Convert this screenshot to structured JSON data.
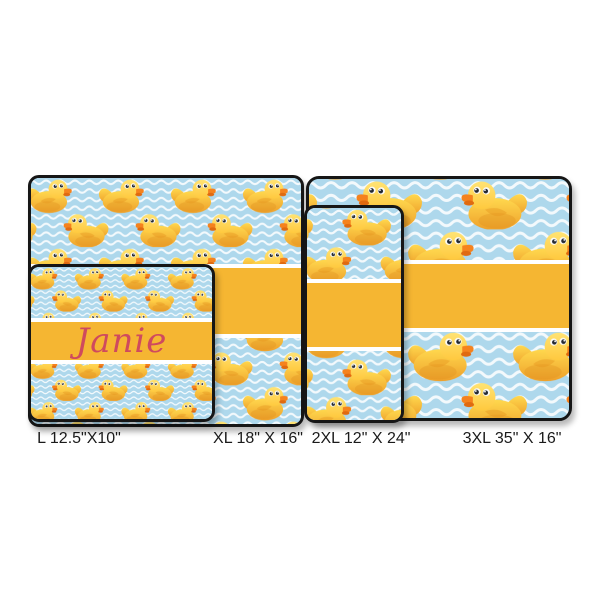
{
  "personalization": {
    "name": "Janie",
    "text_color": "#cf4a5e"
  },
  "sizes": [
    {
      "code": "L",
      "label": "L 12.5\"X10\""
    },
    {
      "code": "XL",
      "label": "XL 18\" X 16\""
    },
    {
      "code": "2XL",
      "label": "2XL 12\" X 24\""
    },
    {
      "code": "3XL",
      "label": "3XL 35\" X 16\""
    }
  ],
  "pattern": {
    "icon": "rubber-duck-pattern",
    "description_colors": {
      "band_yellow": "#f5b632",
      "band_stripe_white": "#ffffff",
      "wave_blue": "#aed8ec",
      "wave_line_white": "#ffffff",
      "duck_body_light": "#ffd84e",
      "duck_body_dark": "#eea02a",
      "duck_head_light": "#ffe373",
      "beak_orange": "#f5821d",
      "mat_border_black": "#161616",
      "label_text": "#1a1a1a",
      "page_background": "#ffffff"
    }
  }
}
